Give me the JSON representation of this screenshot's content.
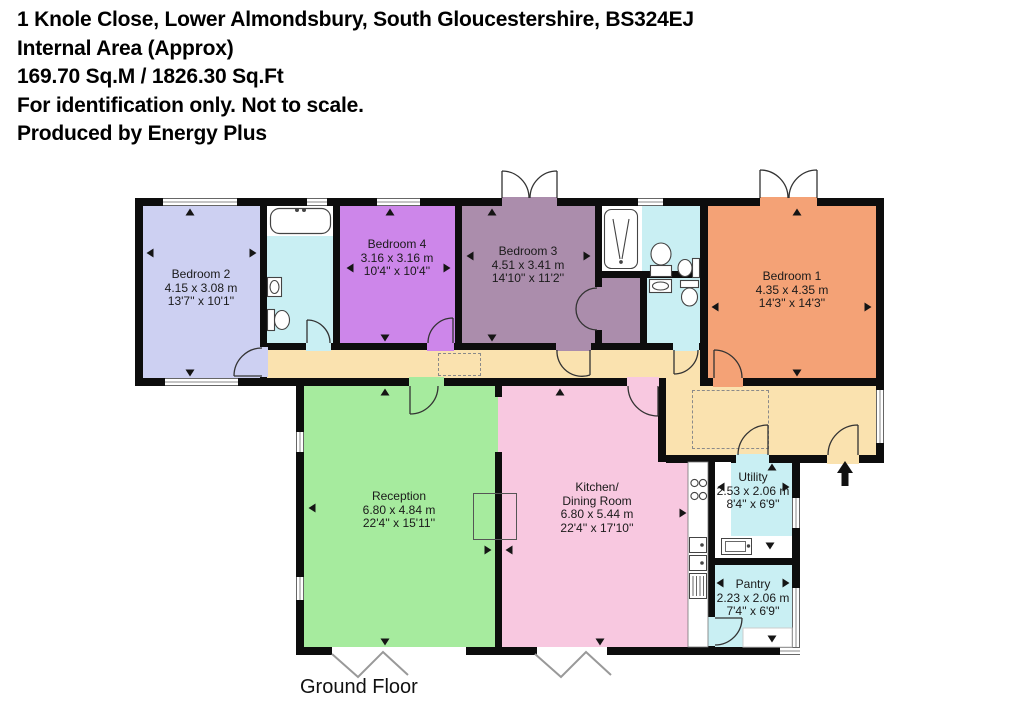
{
  "header": {
    "address": "1 Knole Close, Lower Almondsbury, South Gloucestershire, BS324EJ",
    "area_label": "Internal Area (Approx)",
    "area_value": "169.70 Sq.M / 1826.30 Sq.Ft",
    "disclaimer": "For identification only. Not to scale.",
    "credit": "Produced by Energy Plus"
  },
  "floor_label": "Ground Floor",
  "rooms": [
    {
      "id": "bedroom2",
      "name": "Bedroom 2",
      "size_m": "4.15 x 3.08 m",
      "size_ft": "13'7'' x 10'1''"
    },
    {
      "id": "bedroom4",
      "name": "Bedroom 4",
      "size_m": "3.16 x 3.16 m",
      "size_ft": "10'4'' x 10'4''"
    },
    {
      "id": "bedroom3",
      "name": "Bedroom 3",
      "size_m": "4.51 x 3.41 m",
      "size_ft": "14'10'' x 11'2''"
    },
    {
      "id": "bedroom1",
      "name": "Bedroom 1",
      "size_m": "4.35 x 4.35 m",
      "size_ft": "14'3'' x 14'3''"
    },
    {
      "id": "reception",
      "name": "Reception",
      "size_m": "6.80 x 4.84 m",
      "size_ft": "22'4'' x 15'11''"
    },
    {
      "id": "kitchen",
      "name": "Kitchen/",
      "name2": "Dining Room",
      "size_m": "6.80 x 5.44 m",
      "size_ft": "22'4'' x 17'10''"
    },
    {
      "id": "utility",
      "name": "Utility",
      "size_m": "2.53 x 2.06 m",
      "size_ft": "8'4'' x 6'9''"
    },
    {
      "id": "pantry",
      "name": "Pantry",
      "size_m": "2.23 x 2.06 m",
      "size_ft": "7'4'' x 6'9''"
    }
  ],
  "colors": {
    "bedroom2": "#cdd0f2",
    "bedroom4": "#cd86ea",
    "bedroom3": "#ab8dac",
    "bedroom1": "#f4a276",
    "reception": "#a6eb9e",
    "kitchen": "#f8c8e0",
    "hallway": "#fae2af",
    "wet": "#c9eff3",
    "wall": "#0d0d0d"
  }
}
